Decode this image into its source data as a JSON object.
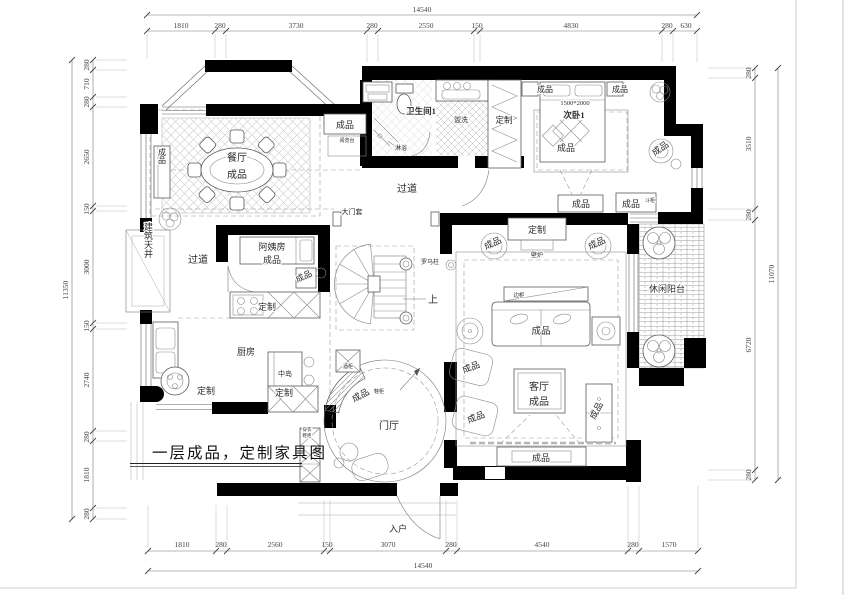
{
  "sheet": {
    "title": "一层成品，定制家具图"
  },
  "colors": {
    "wall": "#000000",
    "line": "#555555",
    "hatch": "#aaaaaa",
    "background": "#ffffff"
  },
  "dims": {
    "top": {
      "overall": "14540",
      "segments": [
        "1810",
        "280",
        "3730",
        "280",
        "2550",
        "150",
        "4830",
        "280",
        "630"
      ]
    },
    "bottom": {
      "overall": "14540",
      "segments": [
        "1810",
        "280",
        "2560",
        "150",
        "3070",
        "280",
        "4540",
        "280",
        "1570"
      ]
    },
    "left": {
      "overall": "11350",
      "segments": [
        "280",
        "710",
        "280",
        "2650",
        "150",
        "3000",
        "150",
        "2740",
        "280",
        "1810",
        "280"
      ]
    },
    "right": {
      "overall": "11070",
      "segments": [
        "280",
        "3510",
        "280",
        "6720",
        "280"
      ]
    }
  },
  "labels": {
    "dining_name": "餐厅",
    "dining_tag": "成品",
    "dining_sideboard": "成品",
    "pantry_tag": "成品",
    "pantry_sub": "阅览台",
    "bath_name": "卫生间1",
    "bath_shower": "淋浴",
    "bath_wash": "盥洗",
    "bedroom_wardrobe": "定制",
    "bedroom_name": "次卧1",
    "bedroom_bed_size": "1500*2000",
    "bedroom_bed": "成品",
    "bedroom_ns_left": "成品",
    "bedroom_ns_right": "成品",
    "bedroom_bench": "成品",
    "bedroom_dresser": "成品",
    "bedroom_dresser_sub": "斗柜",
    "bedroom_armchair": "成品",
    "balcony_name": "休闲阳台",
    "corridor_top": "过道",
    "corridor_left": "过道",
    "door_case": "大门套",
    "roman_column": "罗马柱",
    "stairs_up": "上",
    "nanny_name": "阿姨房",
    "nanny_tag": "成品",
    "nanny_cabinet": "成品",
    "nanny_custom": "定制",
    "shaft_name": "建筑天井",
    "kitchen_name": "厨房",
    "kitchen_island": "中岛",
    "kitchen_custom_left": "定制",
    "kitchen_custom_right": "定制",
    "foyer_name": "门厅",
    "foyer_shoe_tag": "成品",
    "foyer_shoe_sub": "鞋柜",
    "foyer_wine": "酒柜",
    "foyer_mirror_line1": "穿衣",
    "foyer_mirror_line2": "鞋柜",
    "entry_name": "入户",
    "living_top_custom": "定制",
    "living_arm_left": "成品",
    "living_arm_right": "成品",
    "living_fireplace": "壁炉",
    "living_side_cabinet": "边柜",
    "living_sofa": "成品",
    "living_name": "客厅",
    "living_tag": "成品",
    "living_chair1": "成品",
    "living_chair2": "成品",
    "living_cab_right": "成品",
    "living_tv": "成品"
  }
}
